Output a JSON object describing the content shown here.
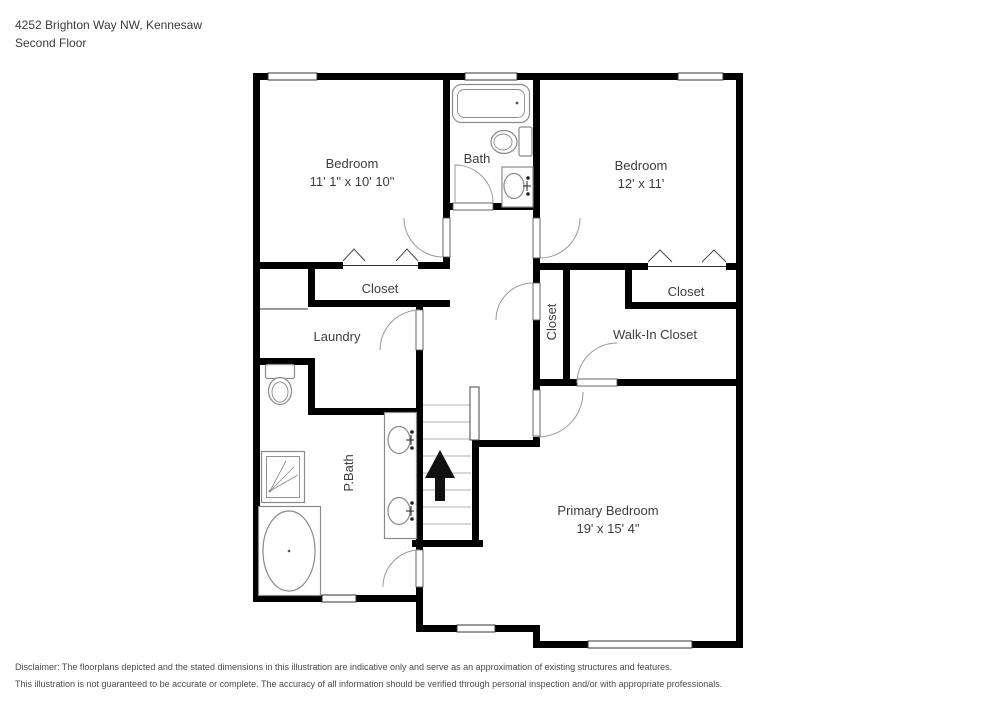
{
  "title": {
    "address": "4252 Brighton Way NW, Kennesaw",
    "floor": "Second Floor"
  },
  "rooms": {
    "bedroom1": {
      "label": "Bedroom",
      "dims": "11' 1\" x 10' 10\""
    },
    "bath": {
      "label": "Bath"
    },
    "bedroom2": {
      "label": "Bedroom",
      "dims": "12' x 11'"
    },
    "closet_left": {
      "label": "Closet"
    },
    "laundry": {
      "label": "Laundry"
    },
    "closet_hall": {
      "label": "Closet"
    },
    "closet_right": {
      "label": "Closet"
    },
    "walk_in_closet": {
      "label": "Walk-In Closet"
    },
    "pbath": {
      "label": "P.Bath"
    },
    "primary_bedroom": {
      "label": "Primary Bedroom",
      "dims": "19' x 15' 4\""
    }
  },
  "disclaimer": {
    "line1": "Disclaimer: The floorplans depicted and the stated dimensions in this illustration are indicative only and serve as an approximation of existing structures and features.",
    "line2": "This illustration is not guaranteed to be accurate or complete. The accuracy of all information should be verified through personal inspection and/or with appropriate professionals."
  },
  "colors": {
    "wall": "#000000",
    "label_text": "#3d3d3d",
    "fixture_outline": "#8a8a8a",
    "background": "#ffffff"
  }
}
